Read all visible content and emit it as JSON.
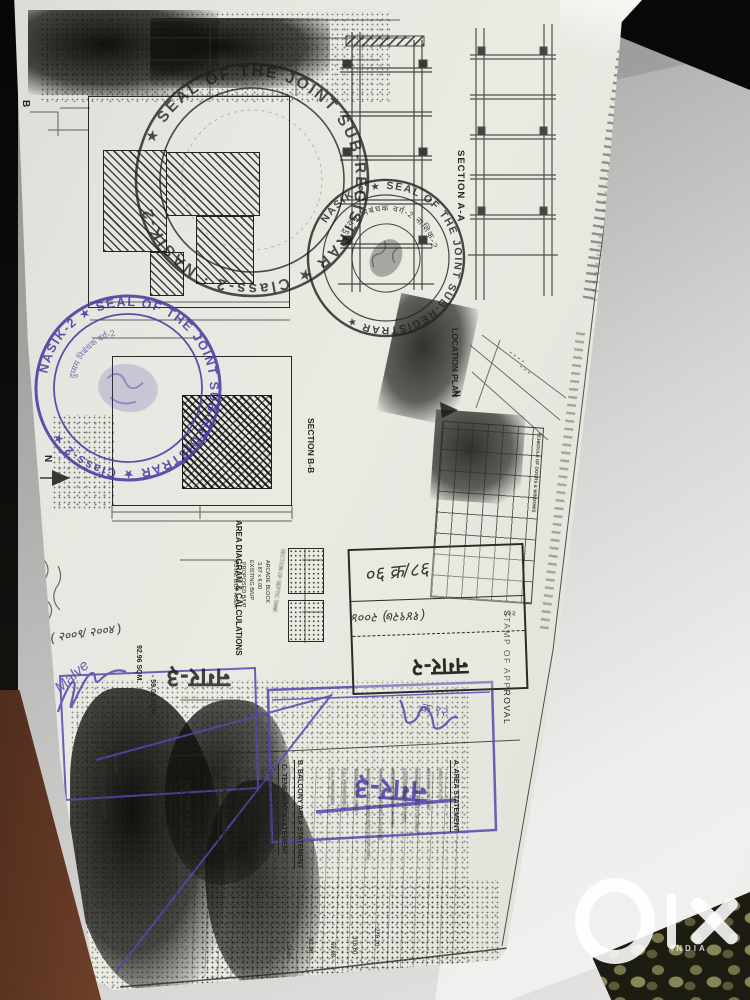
{
  "plan_labels": {
    "ground_floor_plan": "GROUND FLOOR PLAN",
    "marker_b": "B",
    "marker_a": "A",
    "north": "N",
    "section_aa": "SECTION A-A",
    "location_plan": "LOCATION PLAN",
    "section_bb": "SECTION B-B",
    "area_diagram": "AREA DIAGRAM & CALCULATIONS",
    "septic_label": "SECTION OF SEPTIC TANK",
    "schedule_header": "SCHEDULE OF DOORS & WINDOWS",
    "stamp_of_approval": "STAMP OF APPROVAL"
  },
  "seals": {
    "large_black": {
      "ring_text": "★ SEAL OF THE JOINT SUB-REGISTRAR ★ Class-2 · NASIK-2",
      "color": "#1f1e1b"
    },
    "small_black": {
      "ring_text": "NASIK-2 ★ SEAL OF THE JOINT SUB-REGISTRAR ★",
      "inner_text": "दुय्यम निबंधक वर्ग-2 नाशिक-2",
      "color": "#232220"
    },
    "purple": {
      "ring_text": "NASIK-2 ★ SEAL OF THE JOINT SUB-REGISTRAR ★ Class-2 ★",
      "inner_text": "दुय्यम निबंधक वर्ग-2",
      "color": "#4b3aa3"
    }
  },
  "area_calculations": {
    "rows": [
      "ARCADE BLOCK",
      "3.87 x 6.00",
      "EXISTING B/UP",
      "PROPOSED B/UP",
      "TOTAL B/UP AREA"
    ],
    "value_1": "92.96 SQM.",
    "value_2": "- 59.08 SQM."
  },
  "stamps": {
    "nagar2_box": {
      "line1_handwritten": "०६ क्र/८६",
      "line2_handwritten": "(१४९२७) २००४",
      "line2_suffix": "२२२",
      "label": "नगर-२"
    },
    "nagar3_black": "नगर-३",
    "nagar3_purple": "नगर-३",
    "handwritten_year": "( २००९/ २००४ )",
    "signature": "Malve",
    "purple_note": "क्र ९२"
  },
  "statements": {
    "area": {
      "heading": "A. AREA STATEMENT",
      "items": [
        "AREA OF PLOT",
        "NET AREA OF PLOT",
        "PERMISSIBLE BUILT UP AREA",
        "EXISTING BUILT UP AREA",
        "PROPOSED BUILT UP AREA",
        "TOTAL BUILT UP AREA [14+15+16]",
        "BALCONY AREA TAKEN INTO FLOOR AREA",
        "TOTAL FLOOR AREA",
        "F.S.I. PERMISSIBLE",
        "F.S.I. PROPOSED"
      ]
    },
    "balcony": {
      "heading": "B. BALCONY AREA STATEMENT"
    },
    "tenement": {
      "heading": "C. TENEMENT STATEMENT",
      "items": [
        "a) NET AREA OF PLOT NO. 7 ABOVE",
        "b) LESS DEDUCTION FOR NON RESID. USE",
        "c) AREA OF TENEMENTS (a-b)",
        "d) TENEMENTS PERMISSIBLE",
        "e) TENEMENTS PROPOSED"
      ]
    },
    "parking": {
      "heading": "D. PARKING STATEMENT",
      "items": [
        "PARKING REQUIRED BY RULE",
        "PARKING PROVIDED"
      ]
    },
    "certificate": {
      "heading": "CERTIFICATE OF AREA",
      "body_lines": [
        "THIS IS TO CERTIFY THAT THE PLOT UNDER REFERENCE",
        "WAS MEASURED ON SITE AND THE AREA OF THE SAME IS",
        "FOUND AS MENTIONED ON PLAN AND AS PER DOCUMENT TALLY",
        "SIGNATURE OF OWNER / ARCHITECT"
      ]
    },
    "values": [
      "278.20",
      "318.60",
      "59.08",
      "92.96",
      "24.60"
    ],
    "architect_line1": "ARCHITECTS & ENGINEERS",
    "architect_line2": "NASHIK"
  },
  "watermark": {
    "brand": "olx",
    "country": "INDIA"
  }
}
